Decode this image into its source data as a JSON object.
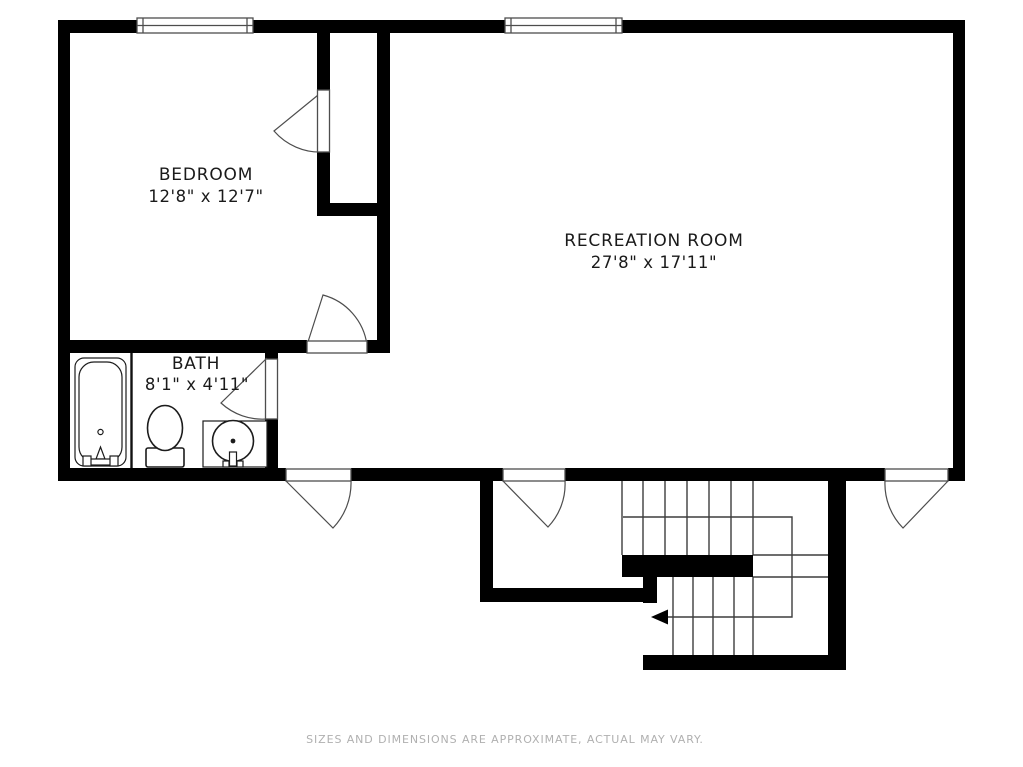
{
  "floorplan": {
    "rooms": [
      {
        "name": "BEDROOM",
        "dimensions": "12'8\" x 12'7\""
      },
      {
        "name": "RECREATION ROOM",
        "dimensions": "27'8\" x 17'11\""
      },
      {
        "name": "BATH",
        "dimensions": "8'1\" x 4'11\""
      }
    ],
    "disclaimer": "SIZES AND DIMENSIONS ARE APPROXIMATE, ACTUAL MAY VARY.",
    "fixtures": [
      "bathtub",
      "toilet",
      "sink"
    ],
    "features": [
      "window",
      "door-swing",
      "staircase",
      "closet"
    ],
    "colors": {
      "walls": "#000000",
      "door_lines": "#4d4d4d",
      "stair_lines": "#3d3d3d",
      "label_text": "#1a1a1a",
      "disclaimer_text": "#b0b0b0",
      "background": "#ffffff"
    }
  }
}
